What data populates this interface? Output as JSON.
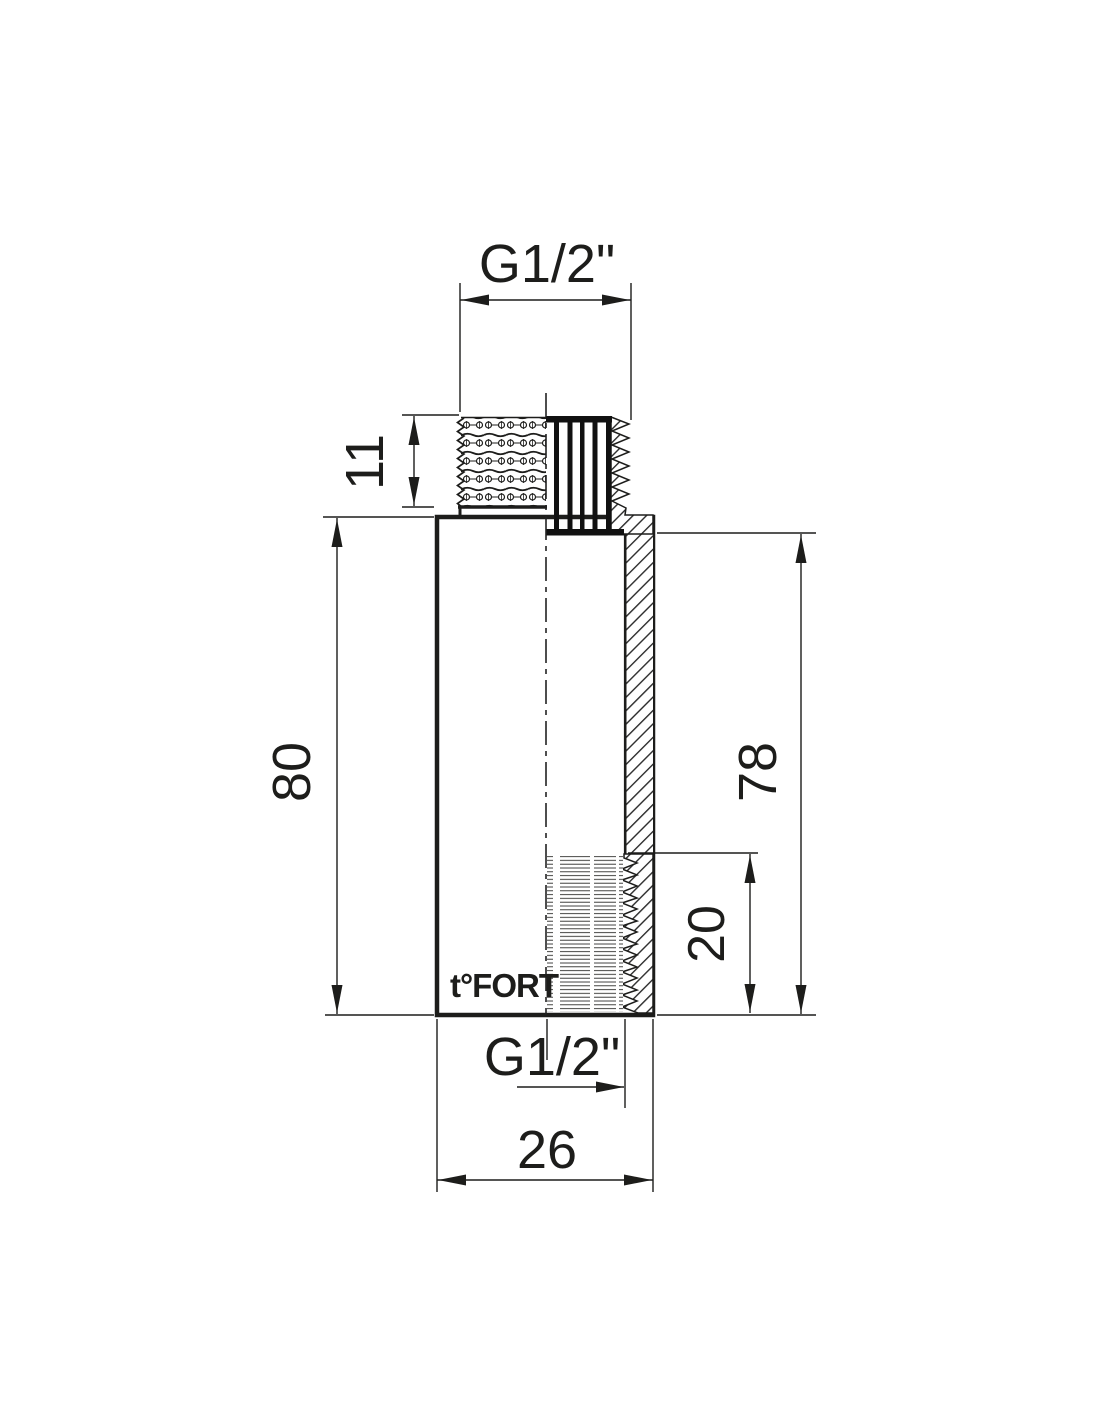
{
  "drawing": {
    "background": "#ffffff",
    "line_color": "#1d1d1b",
    "logo": "t°FORT",
    "dimensions": {
      "top_thread": "G1/2\"",
      "top_thread_length": "11",
      "overall_height": "80",
      "bore_height": "78",
      "bottom_thread_depth": "20",
      "bottom_thread": "G1/2\"",
      "outer_width": "26"
    }
  }
}
